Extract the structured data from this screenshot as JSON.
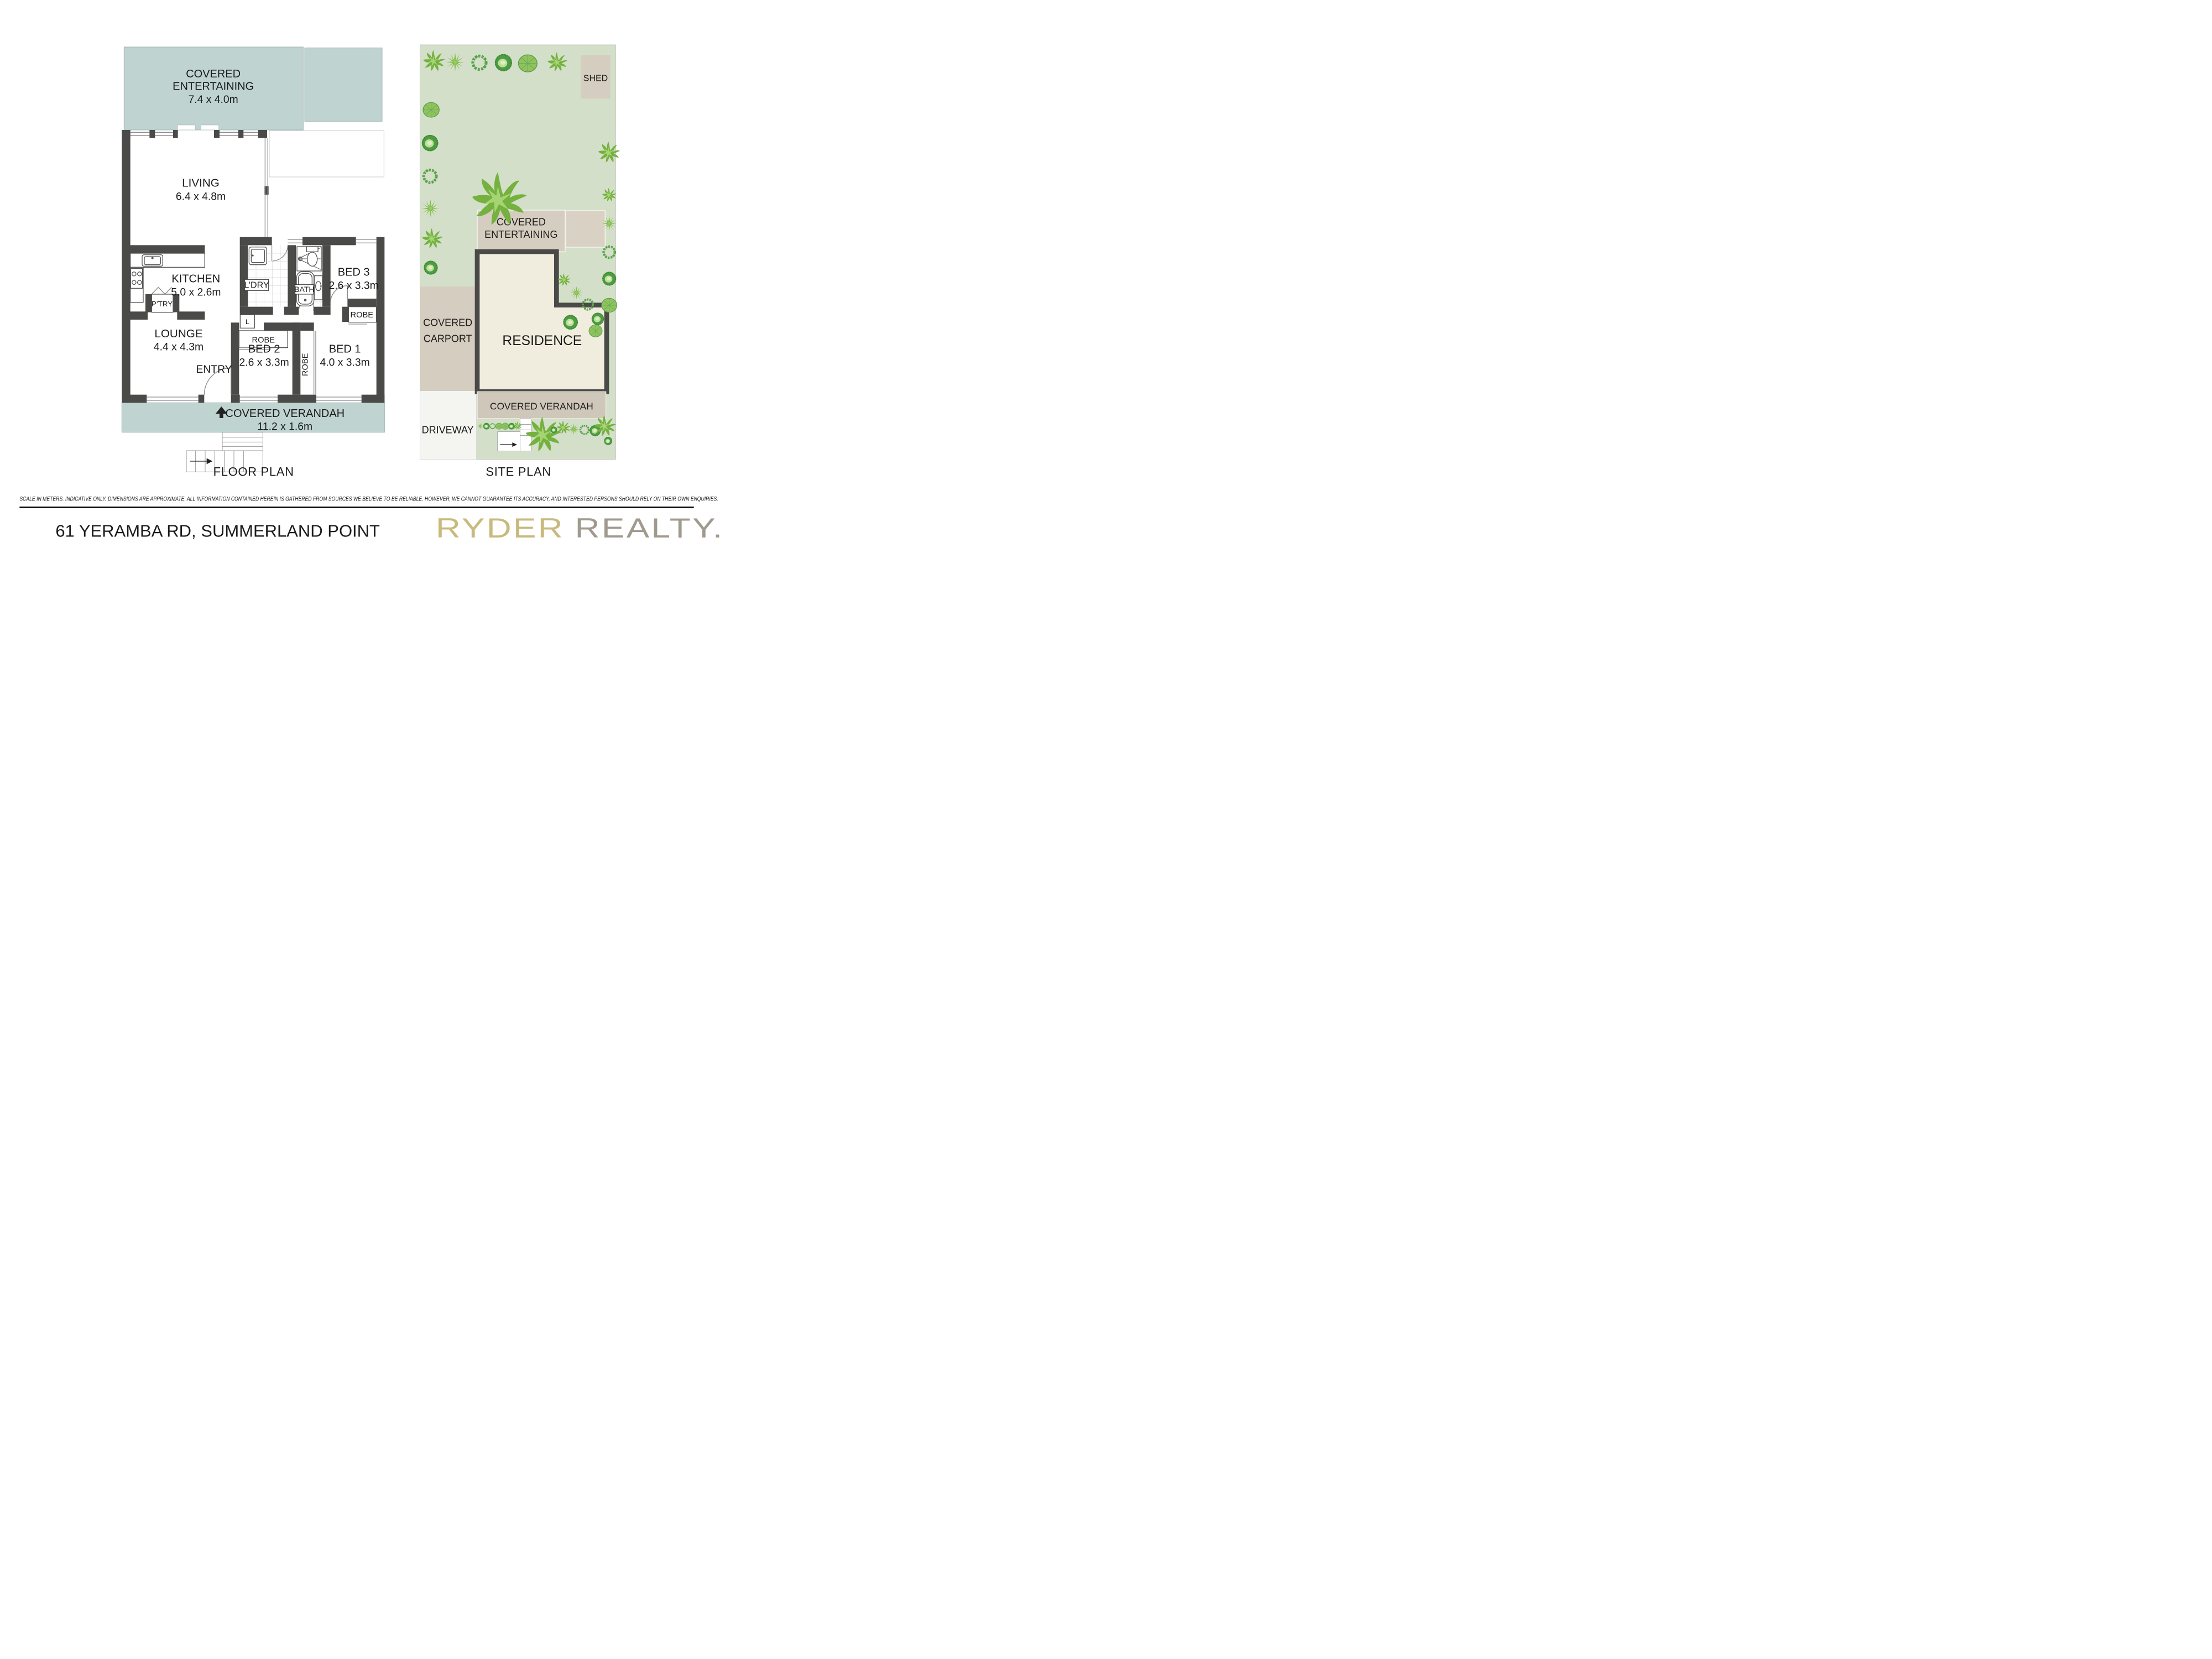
{
  "floor_plan": {
    "title": "FLOOR PLAN",
    "covered_entertaining": {
      "line1": "COVERED",
      "line2": "ENTERTAINING",
      "dims": "7.4 x 4.0m"
    },
    "living": {
      "name": "LIVING",
      "dims": "6.4 x 4.8m"
    },
    "kitchen": {
      "name": "KITCHEN",
      "dims": "5.0 x 2.6m"
    },
    "pantry": "P’TRY",
    "laundry": "L’DRY",
    "linen": "L",
    "bath": "BATH",
    "bed3": {
      "name": "BED 3",
      "dims": "2.6 x 3.3m"
    },
    "lounge": {
      "name": "LOUNGE",
      "dims": "4.4 x 4.3m"
    },
    "entry": "ENTRY",
    "bed2": {
      "name": "BED 2",
      "dims": "2.6 x 3.3m"
    },
    "bed1": {
      "name": "BED 1",
      "dims": "4.0 x 3.3m"
    },
    "robe_bed2": "ROBE",
    "robe_bed1": "ROBE",
    "robe_bed3": "ROBE",
    "verandah": {
      "name": "COVERED VERANDAH",
      "dims": "11.2 x 1.6m"
    }
  },
  "site_plan": {
    "title": "SITE PLAN",
    "shed": "SHED",
    "covered_entertaining": {
      "line1": "COVERED",
      "line2": "ENTERTAINING"
    },
    "carport": {
      "line1": "COVERED",
      "line2": "CARPORT"
    },
    "residence": "RESIDENCE",
    "verandah": "COVERED VERANDAH",
    "driveway": "DRIVEWAY"
  },
  "footer": {
    "disclaimer": "SCALE IN METERS. INDICATIVE ONLY. DIMENSIONS ARE APPROXIMATE. ALL INFORMATION CONTAINED HEREIN IS GATHERED FROM SOURCES WE BELIEVE TO BE RELIABLE. HOWEVER, WE CANNOT GUARANTEE ITS ACCURACY, AND INTERESTED PERSONS SHOULD RELY ON THEIR OWN ENQUIRIES.",
    "address": "61 YERAMBA RD, SUMMERLAND POINT",
    "brand": {
      "name": "RYDER",
      "suffix": "REALTY."
    }
  },
  "colors": {
    "teal": "#bfd3d1",
    "wall": "#4a4a48",
    "site_green": "#d3dfc8",
    "beige": "#d5cdbf",
    "residence_cream": "#f0edde",
    "driveway": "#f4f4f1",
    "brand_gold": "#c8b97d",
    "brand_gray": "#a09a8e"
  }
}
